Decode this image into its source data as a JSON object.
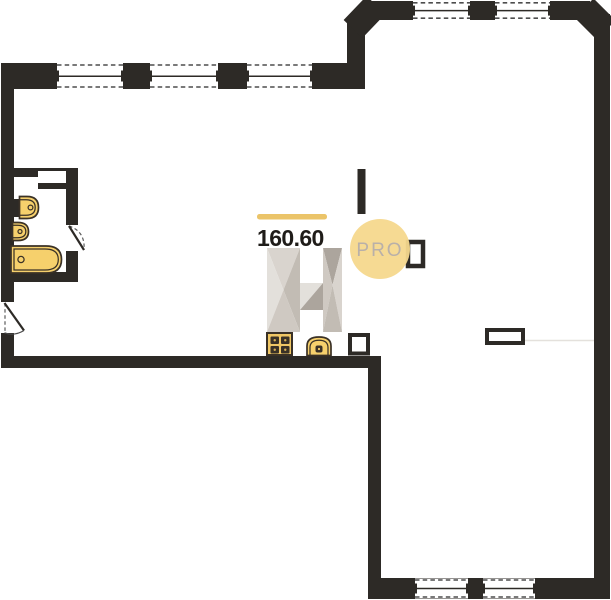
{
  "page": {
    "type": "apartment-floor-plan"
  },
  "floor_plan": {
    "area_label": "160.60",
    "watermark": {
      "text": "PRO"
    },
    "legend": [
      "window",
      "entrance-door",
      "bathroom-door",
      "bathtub",
      "washbasin",
      "hand-sink",
      "stove",
      "kitchen-sink",
      "ventilation-shaft",
      "wall-niche",
      "wall-cabinet"
    ],
    "colors": {
      "wall": "#2d2a26",
      "window_dash": "#4d4d4d",
      "fixture_fill": "#f6d06c",
      "fixture_fill_deep": "#f0c765",
      "fixture_stroke": "#3a3126",
      "accent_gold": "#ebc469",
      "area_text": "#1f1c19",
      "badge_circle": "#f6d88d",
      "badge_text": "#b9b0a9",
      "logo_shade_1": "#e3e0db",
      "logo_shade_2": "#d9d4ce",
      "logo_shade_3": "#cfc9c2",
      "logo_shade_4": "#c2bcb4",
      "logo_shade_5": "#aca59d",
      "faint_line": "#e4e1dc"
    }
  }
}
